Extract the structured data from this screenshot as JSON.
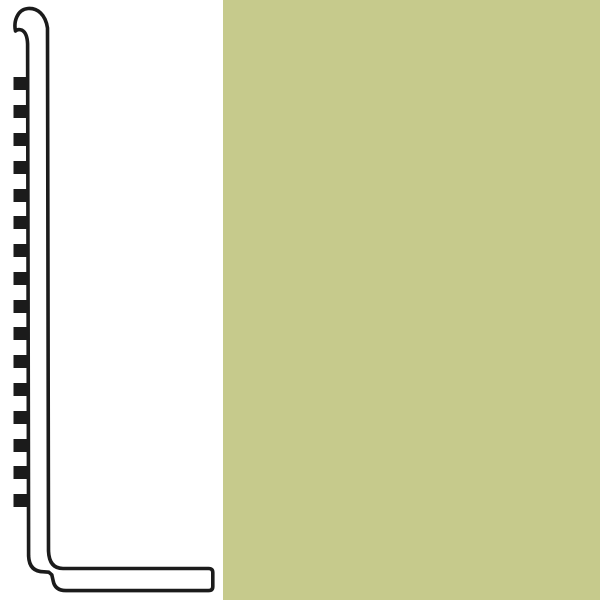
{
  "canvas": {
    "background": "#ffffff"
  },
  "diagram": {
    "line_color": "#1b1b1b",
    "fill_color": "#ffffff",
    "teeth_color": "#1b1b1b",
    "teeth_x": 13.5,
    "teeth_width": 14,
    "teeth_height": 13,
    "teeth_y": [
      77,
      105,
      133,
      161,
      189,
      216,
      244,
      272,
      300,
      327,
      355,
      383,
      411,
      439,
      466,
      494
    ]
  },
  "swatch": {
    "color": "#c6ca8c"
  }
}
